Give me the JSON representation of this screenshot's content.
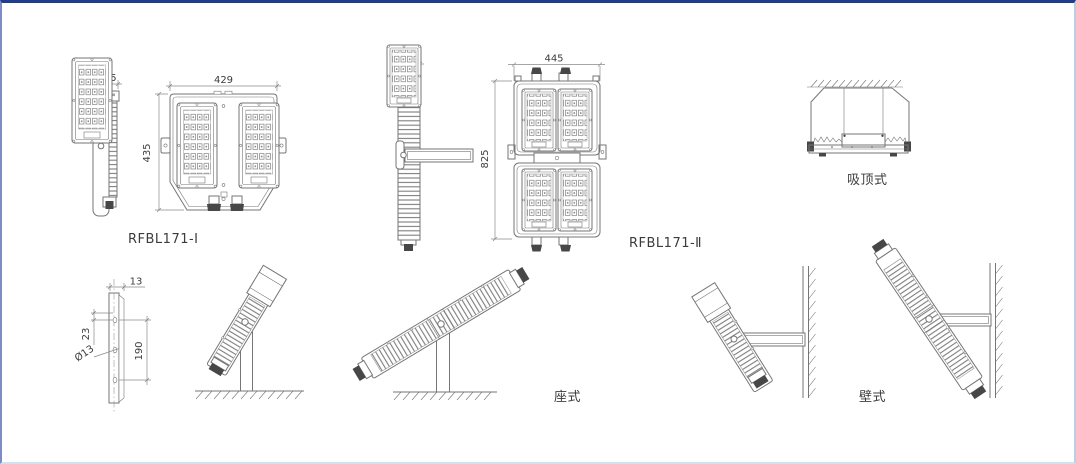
{
  "frame": {
    "top_border": "#1e3d8f",
    "left_border": "#7d8cc4",
    "right_border": "#b9cfe2",
    "bottom_border": "#cfe2ef",
    "background": "#ffffff",
    "line": "#767676",
    "dim": "#8a8a8a",
    "dark": "#474747",
    "text": "#3c3c3c"
  },
  "views": {
    "model1": {
      "label": "RFBL171-Ⅰ",
      "side_width": "88.5",
      "front_width": "429",
      "front_height": "435"
    },
    "model2": {
      "label": "RFBL171-Ⅱ",
      "side_width": "88.5",
      "front_width": "445",
      "front_height": "825"
    },
    "ceiling": {
      "label": "吸顶式"
    },
    "bracket": {
      "plate_width": "13",
      "hole_offset": "23",
      "hole_span": "190",
      "hole_diameter": "Ø13"
    },
    "pedestal": {
      "label": "座式"
    },
    "wall": {
      "label": "壁式"
    }
  }
}
